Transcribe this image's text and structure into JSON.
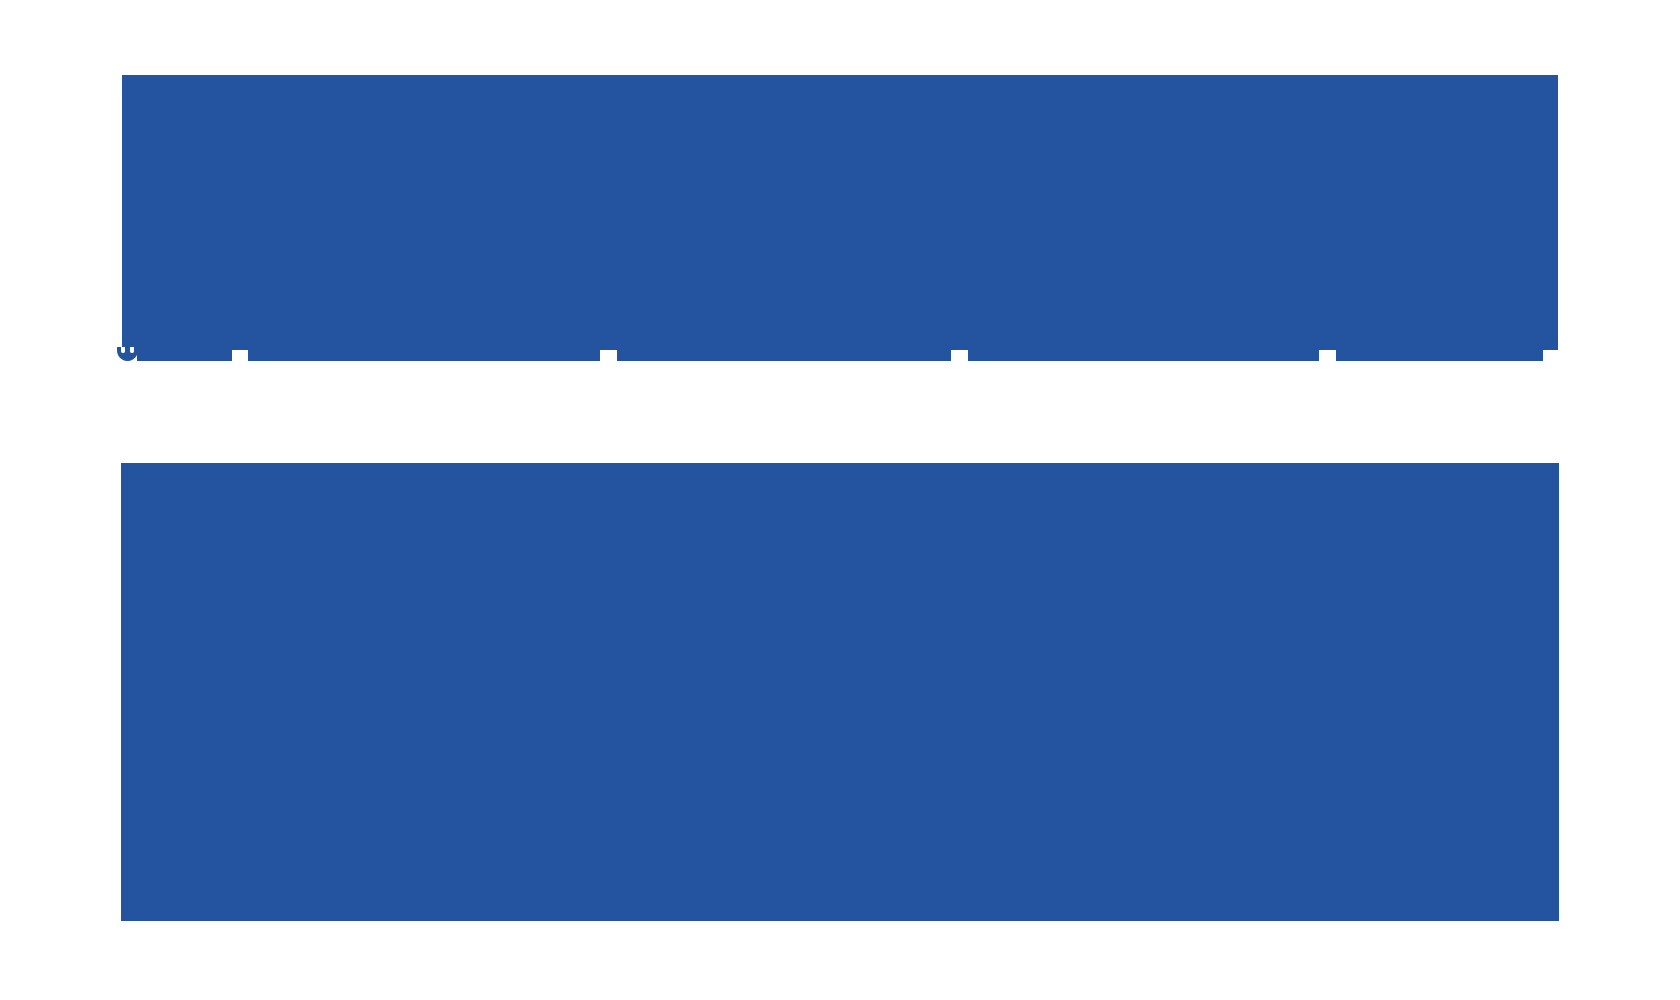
{
  "canvas": {
    "background_color": "#ffffff",
    "redaction_color": "#24549F"
  },
  "blocks": {
    "top_block": {
      "name": "large-redaction-block-top",
      "content_visible": false
    },
    "bottom_block": {
      "name": "large-redaction-block-bottom",
      "content_visible": false
    }
  },
  "strip": {
    "description": "thin redacted text-line strip fused to bottom edge of top block",
    "segment_count": 5
  },
  "icons": {
    "clipped_glyph": "smiley-bottom-arc"
  }
}
